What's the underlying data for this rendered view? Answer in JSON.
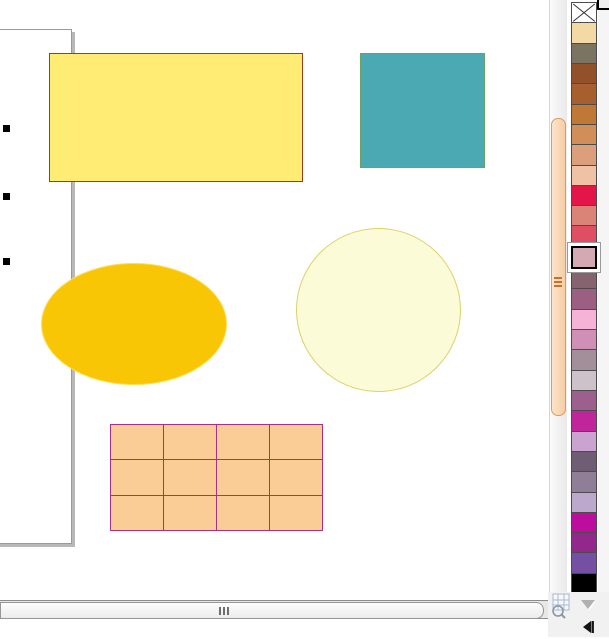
{
  "app": {
    "view": "drawing-canvas",
    "visible_text": ""
  },
  "drawing": {
    "page": {
      "border_color": "#9a9a9a",
      "shadow_color": "#b9b9b9",
      "background": "#ffffff"
    },
    "selection": {
      "handle_count": 3,
      "handle_color": "#000000"
    },
    "shapes": [
      {
        "id": "rectangle",
        "kind": "rectangle",
        "fill": "#FFEC75",
        "stroke": "#A03B20"
      },
      {
        "id": "square",
        "kind": "square",
        "fill": "#4BA9B3",
        "stroke": "#69A361"
      },
      {
        "id": "ellipse",
        "kind": "ellipse",
        "fill": "#F9C605",
        "stroke": "#FFDC50"
      },
      {
        "id": "circle",
        "kind": "circle",
        "fill": "#FBFBD8",
        "stroke": "#DFD065"
      },
      {
        "id": "table",
        "kind": "table-grid",
        "fill": "#FACD96",
        "stroke": "#AC2E86",
        "rows": 3,
        "cols": 4
      }
    ]
  },
  "palette": {
    "selected_index": 12,
    "swatches": [
      {
        "name": "no-color",
        "type": "none",
        "color": "#FFFFFF"
      },
      {
        "name": "wheat",
        "color": "#F3D9A3"
      },
      {
        "name": "olive-gray",
        "color": "#7C7463"
      },
      {
        "name": "saddle-brown",
        "color": "#93512B"
      },
      {
        "name": "rust",
        "color": "#A75F2F"
      },
      {
        "name": "ochre",
        "color": "#C07836"
      },
      {
        "name": "copper",
        "color": "#D18E58"
      },
      {
        "name": "salmon",
        "color": "#DC9F7B"
      },
      {
        "name": "peach",
        "color": "#EFC2A6"
      },
      {
        "name": "crimson",
        "color": "#E41549"
      },
      {
        "name": "dusty-rose",
        "color": "#DA8478"
      },
      {
        "name": "raspberry",
        "color": "#E04E63"
      },
      {
        "name": "dusty-pink",
        "color": "#D4A9B2"
      },
      {
        "name": "gray-mauve",
        "color": "#85636F"
      },
      {
        "name": "plum",
        "color": "#9A5F83"
      },
      {
        "name": "light-pink",
        "color": "#F6B3D7"
      },
      {
        "name": "orchid",
        "color": "#D08FB6"
      },
      {
        "name": "mauve-gray",
        "color": "#A38F99"
      },
      {
        "name": "light-gray-lilac",
        "color": "#CEC2CA"
      },
      {
        "name": "purple-mauve",
        "color": "#9D5F8D"
      },
      {
        "name": "magenta",
        "color": "#C1259C"
      },
      {
        "name": "lilac",
        "color": "#CBA3D1"
      },
      {
        "name": "dark-gray-purple",
        "color": "#6F5E73"
      },
      {
        "name": "gray-purple",
        "color": "#8F7E95"
      },
      {
        "name": "light-lilac",
        "color": "#BCA7CD"
      },
      {
        "name": "fuchsia",
        "color": "#BC0D9E"
      },
      {
        "name": "dark-magenta",
        "color": "#93288C"
      },
      {
        "name": "violet",
        "color": "#7350A3"
      },
      {
        "name": "black",
        "color": "#000000"
      }
    ]
  },
  "scrollbars": {
    "vertical": {
      "thumb_fill": "#F8D2AC",
      "thumb_border": "#DD9B61",
      "grip_color": "#C4722E"
    },
    "horizontal": {
      "thumb_fill": "#F4F4F4",
      "thumb_border": "#969696",
      "grip_color": "#6F6F6F"
    }
  },
  "icons": {
    "no_color": "x-no-color-icon",
    "navigator": "navigator-icon",
    "palette_scroll_down": "chevron-down-icon",
    "skip_start": "skip-start-icon"
  }
}
